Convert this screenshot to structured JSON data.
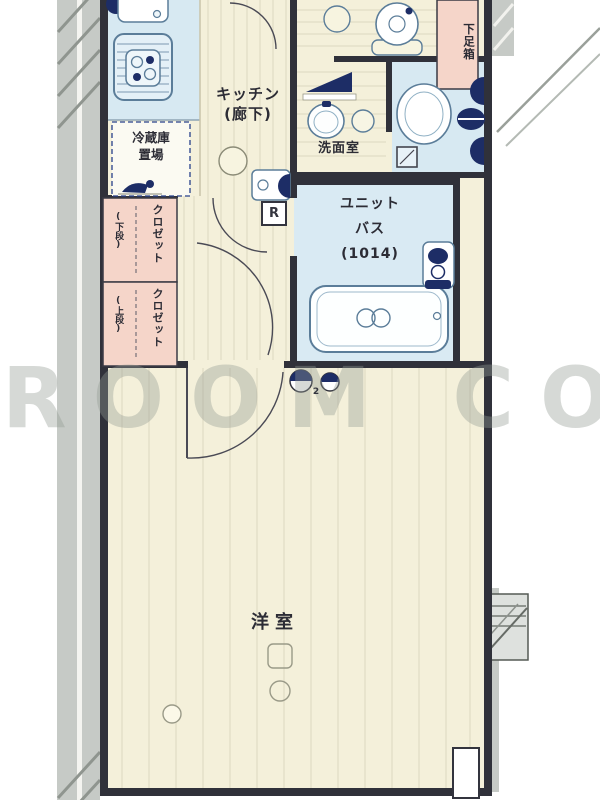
{
  "plan_title": "1K apartment floor plan",
  "watermark": {
    "text": "ROOM CORE"
  },
  "rooms": {
    "kitchen": {
      "label_line1": "キッチン",
      "label_line2": "(廊下)"
    },
    "fridge_space": {
      "label_line1": "冷蔵庫",
      "label_line2": "置場"
    },
    "washroom": {
      "label": "洗面室"
    },
    "unit_bath": {
      "label_line1": "ユニット",
      "label_line2": "バス",
      "label_line3": "(1014)"
    },
    "western_room": {
      "label": "洋室"
    },
    "closet_upper": {
      "label": "クロゼット",
      "sub_label": "(下段)"
    },
    "closet_lower": {
      "label": "クロゼット",
      "sub_label": "(上段)"
    },
    "shoe_box": {
      "label": "下足箱"
    }
  },
  "markers": {
    "water_heater_label": "R",
    "outlet_count": "2"
  },
  "colors": {
    "wall": "#30313a",
    "wood_floor": "#f4f0da",
    "plank_line": "#ddd8c0",
    "wet_area_blue": "#d7e9f2",
    "closet_pink": "#f5d5c9",
    "fixture_navy": "#1d2d66",
    "fixture_outline": "#5b7d99",
    "exterior_gray": "#c6cac6",
    "watermark_gray": "#949a94"
  }
}
